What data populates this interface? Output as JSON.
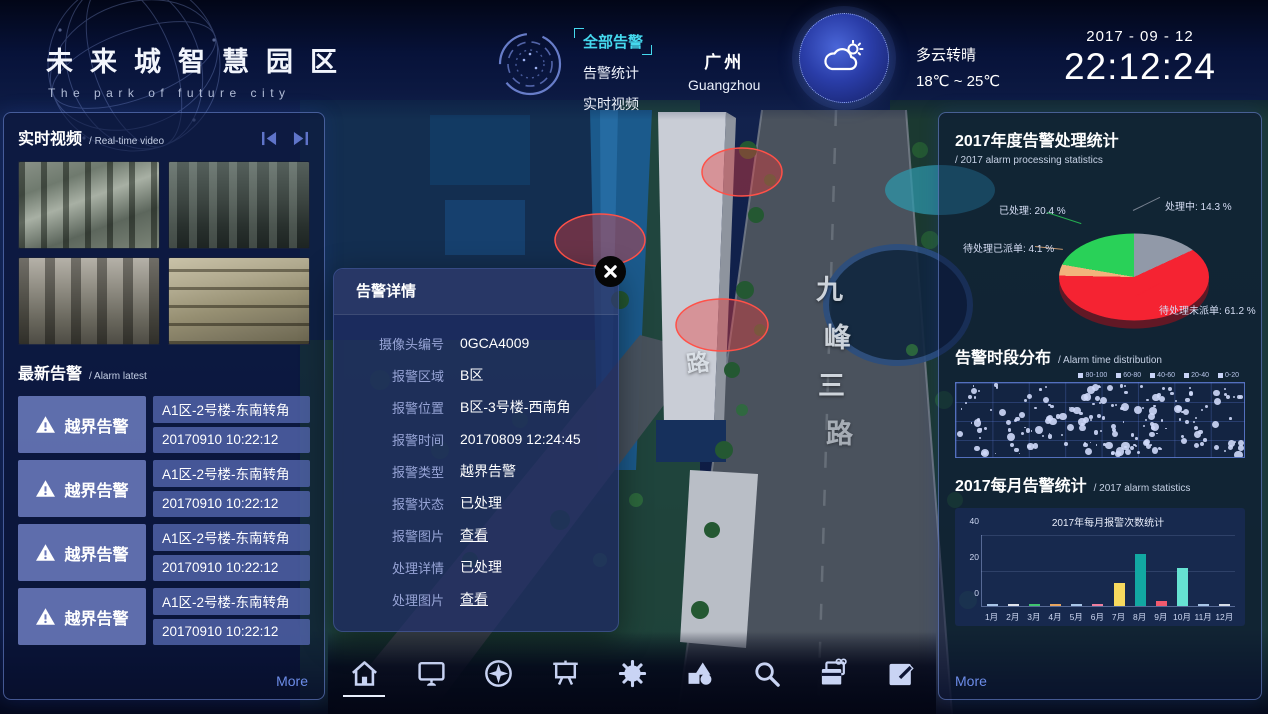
{
  "header": {
    "title": "未来城智慧园区",
    "subtitle": "The park of future city",
    "nav": {
      "items": [
        {
          "label": "全部告警",
          "active": true
        },
        {
          "label": "告警统计",
          "active": false
        },
        {
          "label": "实时视频",
          "active": false
        }
      ]
    },
    "city": {
      "cn": "广州",
      "en": "Guangzhou"
    },
    "weather": {
      "condition": "多云转晴",
      "temp": "18℃ ~ 25℃"
    },
    "date": "2017 - 09 - 12",
    "time": "22:12:24"
  },
  "left_panel": {
    "video": {
      "title": "实时视频",
      "subtitle": "/ Real-time video"
    },
    "alarm": {
      "title": "最新告警",
      "subtitle": "/ Alarm latest",
      "items": [
        {
          "type": "越界告警",
          "location": "A1区-2号楼-东南转角",
          "time": "20170910 10:22:12"
        },
        {
          "type": "越界告警",
          "location": "A1区-2号楼-东南转角",
          "time": "20170910 10:22:12"
        },
        {
          "type": "越界告警",
          "location": "A1区-2号楼-东南转角",
          "time": "20170910 10:22:12"
        },
        {
          "type": "越界告警",
          "location": "A1区-2号楼-东南转角",
          "time": "20170910 10:22:12"
        }
      ],
      "more": "More"
    }
  },
  "modal": {
    "title": "告警详情",
    "fields": [
      {
        "label": "摄像头编号",
        "value": "0GCA4009",
        "link": false
      },
      {
        "label": "报警区域",
        "value": "B区",
        "link": false
      },
      {
        "label": "报警位置",
        "value": "B区-3号楼-西南角",
        "link": false
      },
      {
        "label": "报警时间",
        "value": "20170809 12:24:45",
        "link": false
      },
      {
        "label": "报警类型",
        "value": "越界告警",
        "link": false
      },
      {
        "label": "报警状态",
        "value": "已处理",
        "link": false
      },
      {
        "label": "报警图片",
        "value": "查看",
        "link": true
      },
      {
        "label": "处理详情",
        "value": "已处理",
        "link": false
      },
      {
        "label": "处理图片",
        "value": "查看",
        "link": true
      }
    ]
  },
  "right_panel": {
    "pie_section": {
      "title": "2017年度告警处理统计",
      "subtitle": "/ 2017 alarm processing statistics"
    },
    "scatter_section": {
      "title": "告警时段分布",
      "subtitle": "/ Alarm time distribution"
    },
    "bar_section": {
      "title": "2017每月告警统计",
      "subtitle": "/ 2017 alarm statistics"
    },
    "more": "More"
  },
  "chart_data": [
    {
      "type": "pie",
      "title": "2017年度告警处理统计",
      "slices": [
        {
          "label": "已处理",
          "value": 20.4,
          "color": "#29d158"
        },
        {
          "label": "处理中",
          "value": 14.3,
          "color": "#9199a8"
        },
        {
          "label": "待处理已派单",
          "value": 4.1,
          "color": "#f2b37c"
        },
        {
          "label": "待处理未派单",
          "value": 61.2,
          "color": "#f52332"
        }
      ],
      "draw_order": [
        1,
        3,
        2,
        0
      ],
      "legend_position": "around-labels"
    },
    {
      "type": "scatter",
      "title": "告警时段分布",
      "legend": [
        "80-100",
        "60-80",
        "40-60",
        "20-40",
        "0-20"
      ],
      "points_note": "dense unlabeled punch-card of ~190 dots, sizes vary with count",
      "point_count": 190,
      "grid": {
        "cols": 8,
        "rows": 4
      }
    },
    {
      "type": "bar",
      "title": "2017年每月报警次数统计",
      "categories": [
        "1月",
        "2月",
        "3月",
        "4月",
        "5月",
        "6月",
        "7月",
        "8月",
        "9月",
        "10月",
        "11月",
        "12月"
      ],
      "values": [
        0.6,
        0.6,
        0.9,
        0.9,
        0.6,
        0.9,
        13,
        29,
        3,
        21,
        0.6,
        0.5
      ],
      "colors": [
        "#a9c6e8",
        "#e0e4ec",
        "#3fc46e",
        "#e8a45e",
        "#a9c6e8",
        "#ef7e9e",
        "#f7d95e",
        "#12a8a2",
        "#f25a6e",
        "#66e2d2",
        "#a9c6e8",
        "#d6dde8"
      ],
      "ylim": [
        0,
        40
      ],
      "yticks": [
        "40",
        "20",
        "0"
      ],
      "xlabel": "",
      "ylabel": ""
    }
  ],
  "map": {
    "road_labels": [
      "九",
      "峰",
      "三",
      "路"
    ],
    "side_label": "路",
    "alarm_zone_color": "#ff5148"
  },
  "toolbar": {
    "icons": [
      "home",
      "monitor",
      "compass",
      "screen",
      "gear",
      "shapes",
      "search",
      "cards",
      "edit"
    ],
    "active_icon": "home"
  },
  "colors": {
    "accent_cyan": "#45d9ee",
    "link_blue": "#6c8ce8",
    "panel_border": "#7694e4",
    "alarm_box_blue": "#6a7abc"
  }
}
